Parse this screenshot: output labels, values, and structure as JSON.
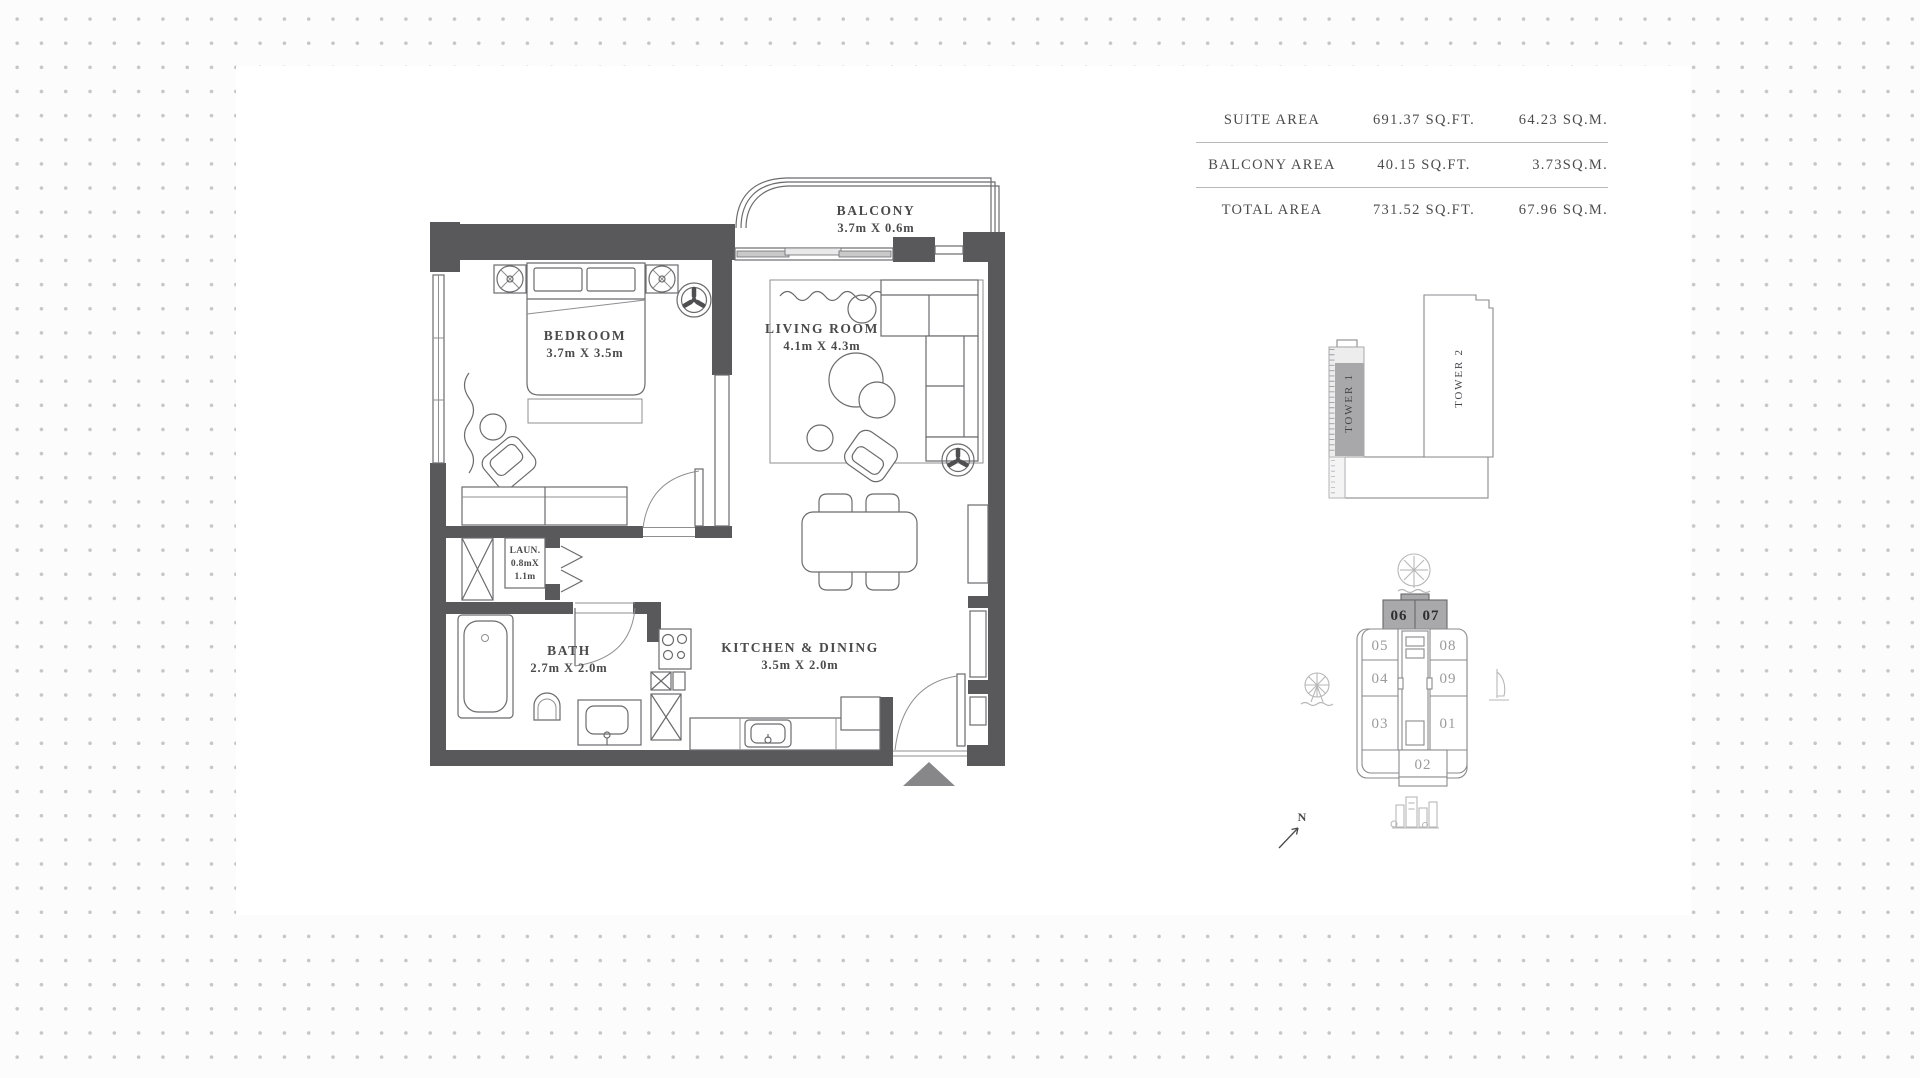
{
  "area_table": {
    "rows": [
      {
        "label": "SUITE AREA",
        "sqft": "691.37 SQ.FT.",
        "sqm": "64.23 SQ.M."
      },
      {
        "label": "BALCONY AREA",
        "sqft": "40.15 SQ.FT.",
        "sqm": "3.73SQ.M."
      },
      {
        "label": "TOTAL AREA",
        "sqft": "731.52 SQ.FT.",
        "sqm": "67.96 SQ.M."
      }
    ]
  },
  "floorplan": {
    "balcony": {
      "name": "BALCONY",
      "dims": "3.7m X 0.6m"
    },
    "bedroom": {
      "name": "BEDROOM",
      "dims": "3.7m X 3.5m"
    },
    "living": {
      "name": "LIVING ROOM",
      "dims": "4.1m X 4.3m"
    },
    "laundry": {
      "line1": "LAUN.",
      "line2": "0.8mX",
      "line3": "1.1m"
    },
    "bath": {
      "name": "BATH",
      "dims": "2.7m X 2.0m"
    },
    "kitchen": {
      "name": "KITCHEN & DINING",
      "dims": "3.5m X 2.0m"
    }
  },
  "towers": {
    "tower1": "TOWER 1",
    "tower2": "TOWER 2"
  },
  "keyplan": {
    "units": {
      "u06": "06",
      "u07": "07",
      "u05": "05",
      "u04": "04",
      "u03": "03",
      "u08": "08",
      "u09": "09",
      "u01": "01",
      "u02": "02"
    },
    "highlighted_units": "06, 07"
  },
  "compass": {
    "north": "N"
  },
  "colors": {
    "wall": "#59595b",
    "unit_highlight": "#a9a9ab",
    "dot": "#c6c6c6"
  }
}
